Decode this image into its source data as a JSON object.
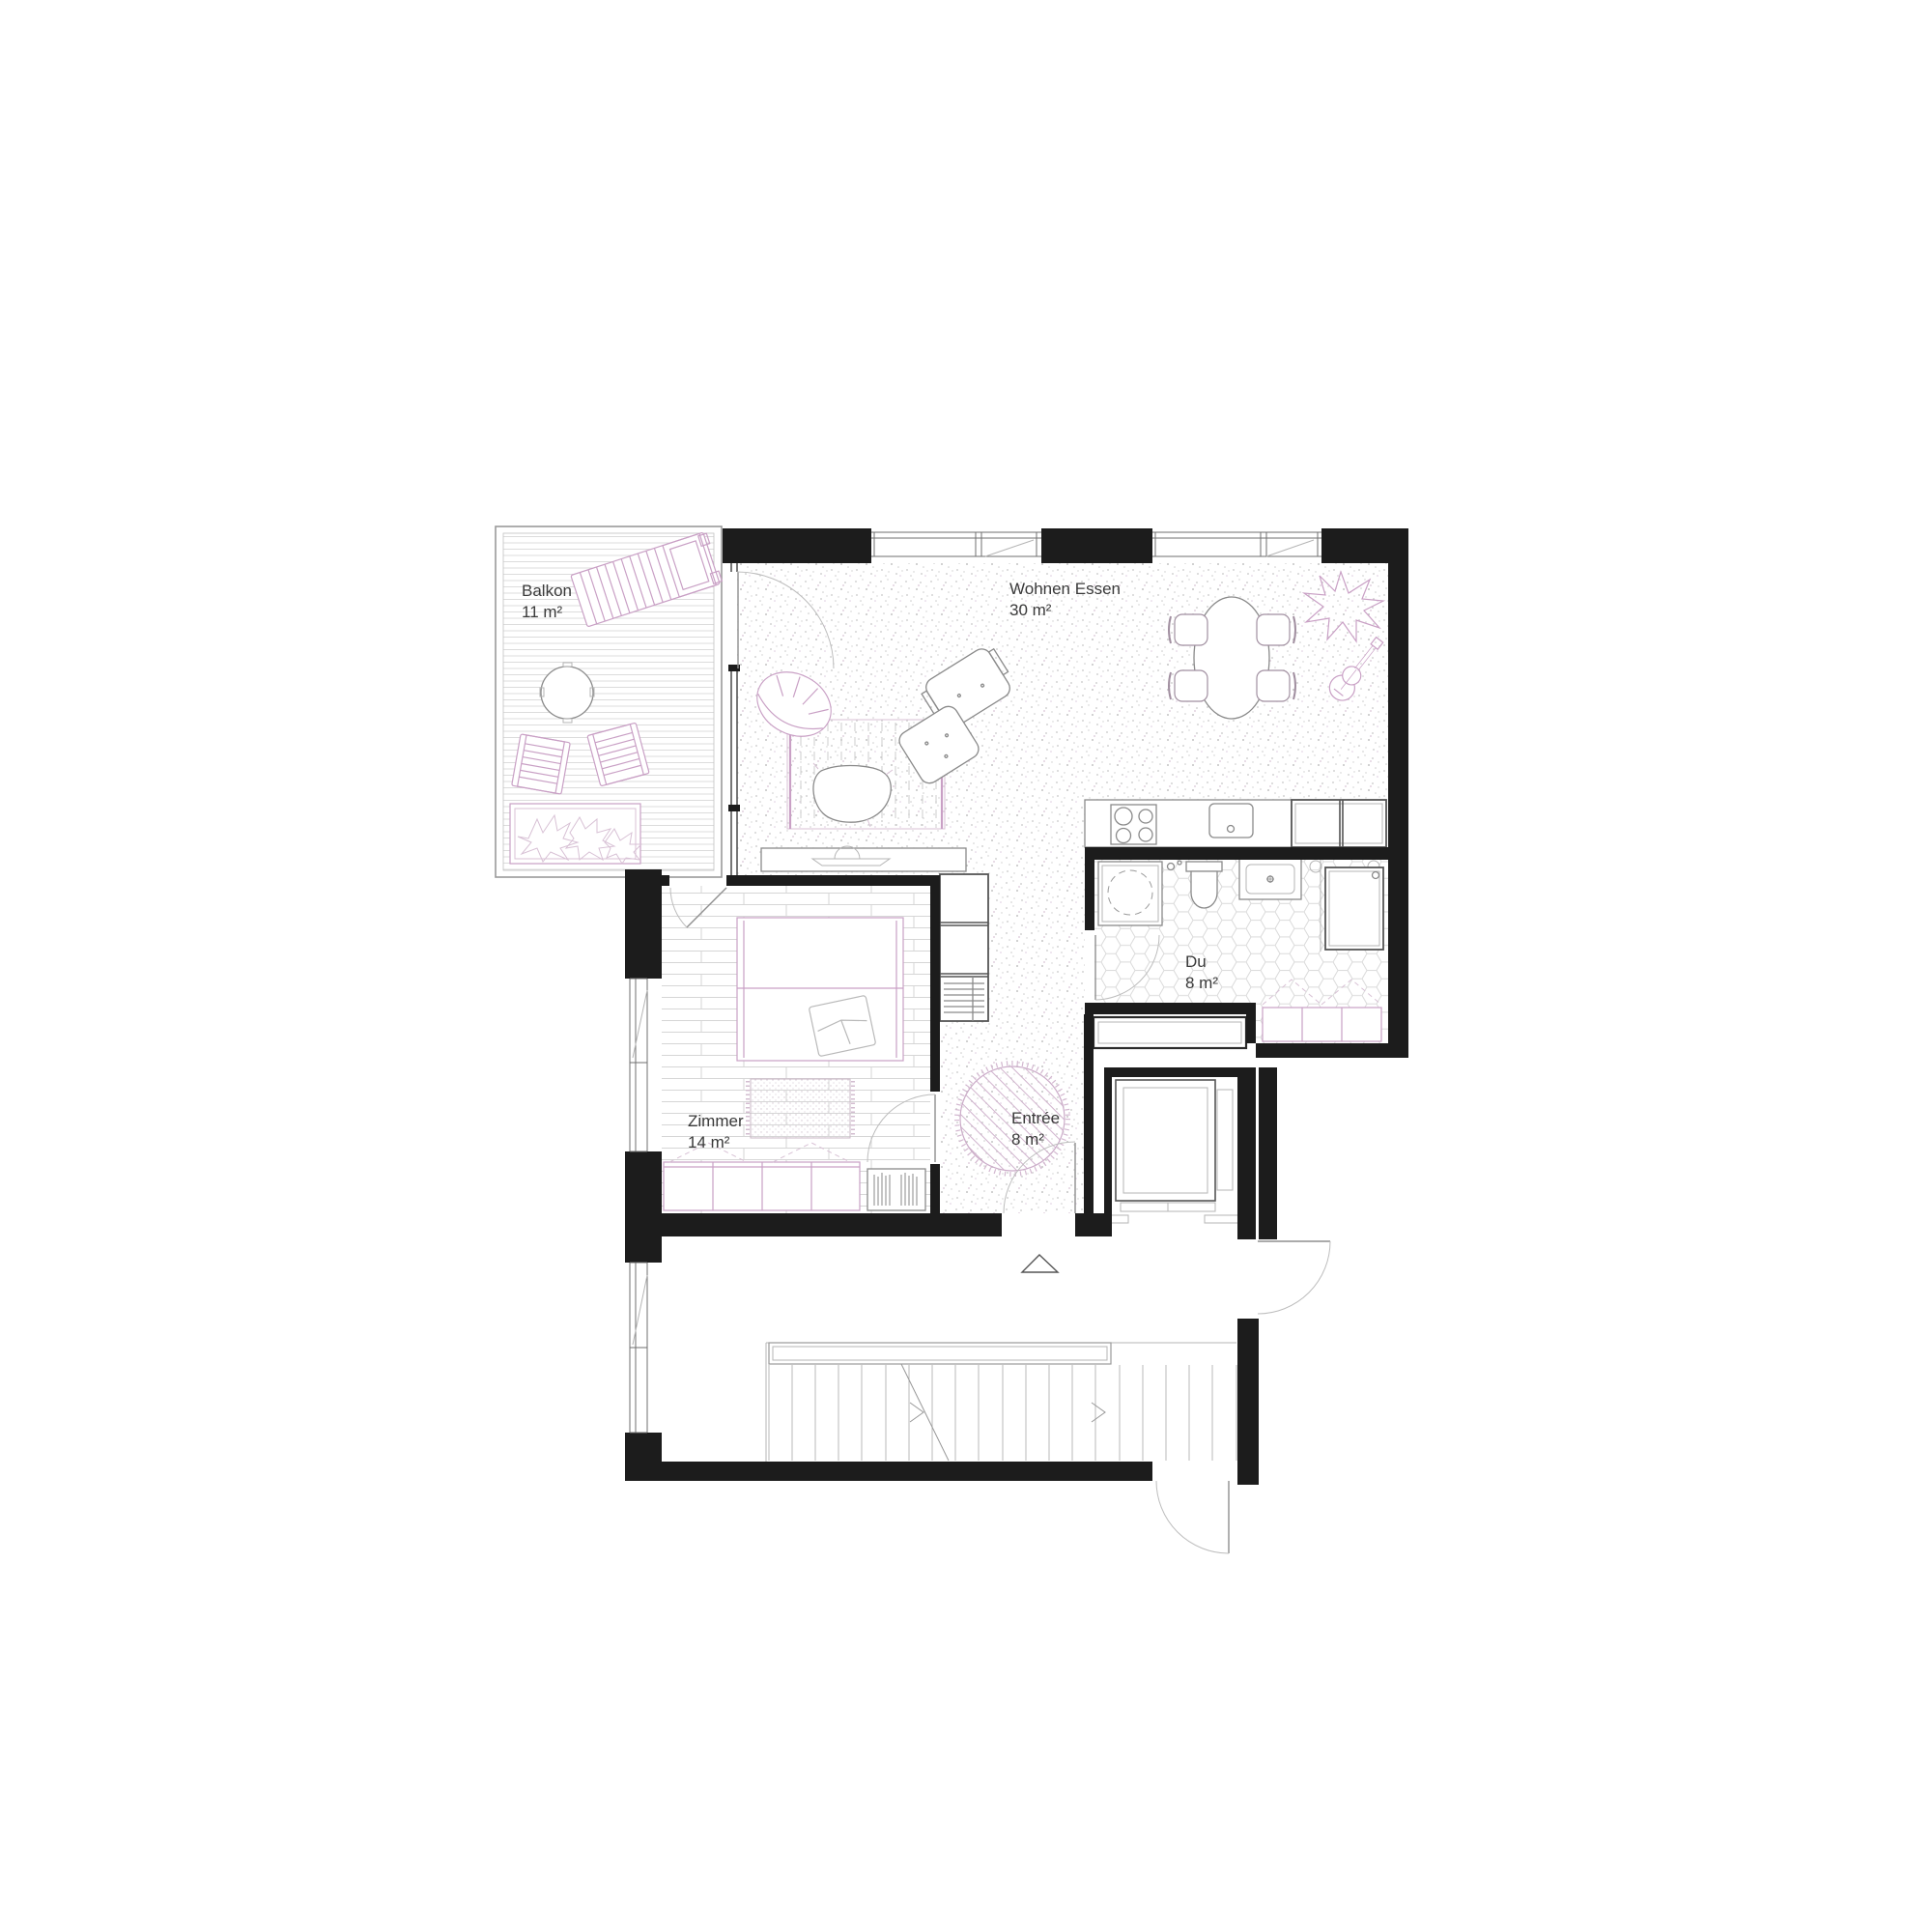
{
  "drawing": {
    "type": "apartment-floor-plan",
    "colors": {
      "background": "#ffffff",
      "wall": "#1c1c1c",
      "furniture_gray": "#8a8a8a",
      "accent_pink": "#c9a0c5",
      "floor_texture": "#d8d8d8",
      "text": "#3a3a3a"
    }
  },
  "rooms": [
    {
      "id": "balkon",
      "name": "Balkon",
      "area": "11 m²",
      "floor": "wood-deck",
      "furniture": [
        "sun-lounger",
        "round-side-table",
        "two-folding-chairs",
        "planter-with-plants"
      ]
    },
    {
      "id": "wohnen-essen",
      "name": "Wohnen Essen",
      "area": "30 m²",
      "floor": "stippled-screed",
      "furniture": [
        "barrel-armchair",
        "lounge-chair-with-ottoman",
        "striped-rug",
        "organic-coffee-table",
        "sideboard",
        "oval-dining-table",
        "four-dining-chairs",
        "plant",
        "guitar",
        "kitchen-counter-cooktop-sink",
        "tall-kitchen-units"
      ]
    },
    {
      "id": "zimmer",
      "name": "Zimmer",
      "area": "14 m²",
      "floor": "wood-planks",
      "furniture": [
        "double-bed",
        "dotted-rug",
        "wardrobe",
        "bookshelf",
        "shelf-unit"
      ]
    },
    {
      "id": "du",
      "name": "Du",
      "area": "8 m²",
      "floor": "hex-tiles",
      "furniture": [
        "shower",
        "toilet",
        "washbasin",
        "tall-cabinet",
        "bench-wardrobe"
      ]
    },
    {
      "id": "entree",
      "name": "Entrée",
      "area": "8 m²",
      "floor": "stippled-screed",
      "furniture": [
        "round-rug"
      ]
    }
  ],
  "core": {
    "elements": [
      "elevator",
      "staircase-with-direction-line",
      "landing",
      "apartment-entry-door",
      "corridor-door",
      "building-entry-door",
      "entry-triangle-marker"
    ]
  }
}
